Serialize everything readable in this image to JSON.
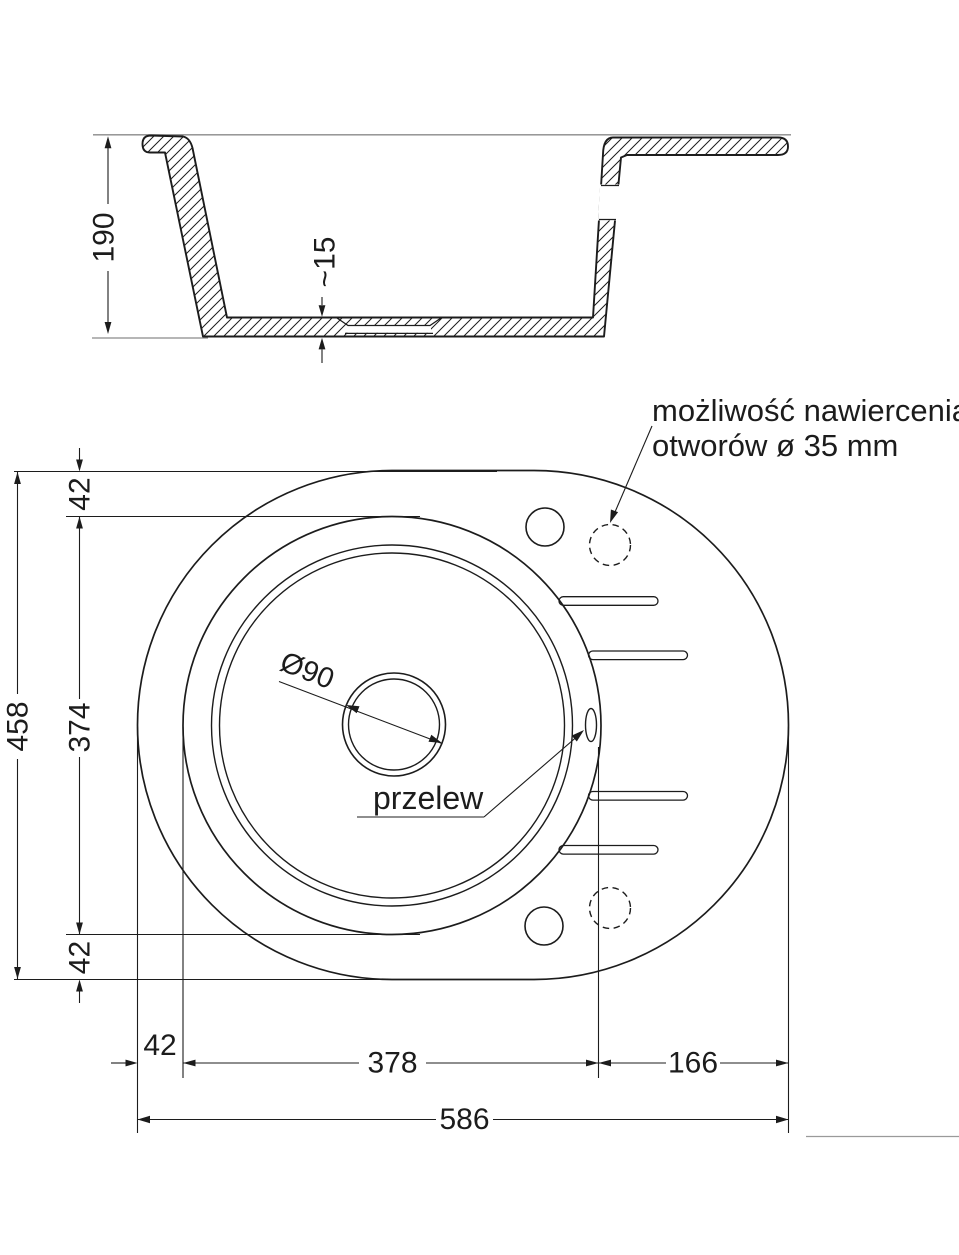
{
  "drawing": {
    "background": "#ffffff",
    "line_color": "#1c1c1c",
    "countertop_line_color": "#8a8a8a",
    "page_edge_line_color": "#9a9a9a",
    "section_view": {
      "depth": "190",
      "drain_recess_depth": "~15"
    },
    "plan_view": {
      "drill_note_line1": "możliwość nawiercenia",
      "drill_note_line2": "otworów ø 35 mm",
      "drain_diameter": "Ø90",
      "overflow_label": "przelew"
    },
    "dimensions": {
      "overall_height": "458",
      "top_edge_to_bowl": "42",
      "bowl_diameter": "374",
      "bowl_to_bottom_edge": "42",
      "left_edge_to_bowl": "42",
      "bowl_width": "378",
      "drainer_width": "166",
      "overall_width": "586"
    }
  }
}
